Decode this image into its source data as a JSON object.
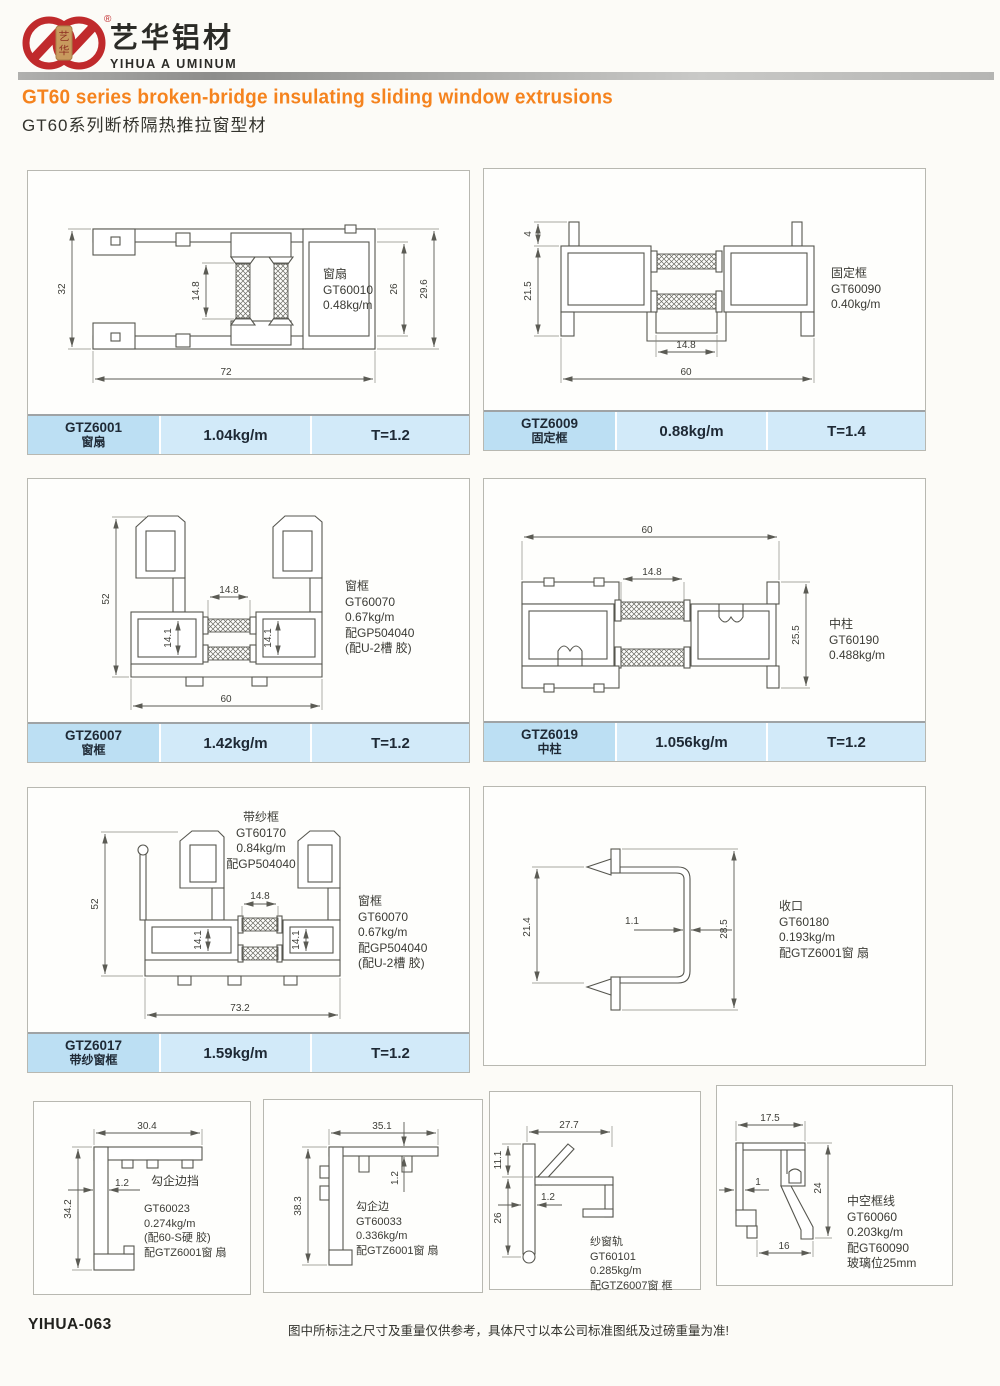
{
  "header": {
    "brand_cn": "艺华铝材",
    "brand_en": "YIHUA A UMINUM",
    "registered": "®",
    "seal_top": "艺",
    "seal_bottom": "华",
    "title_en": "GT60 series broken-bridge insulating sliding window extrusions",
    "title_cn": "GT60系列断桥隔热推拉窗型材"
  },
  "panels": {
    "p1": {
      "label": [
        "窗扇",
        "GT60010",
        "0.48kg/m"
      ],
      "dims": {
        "left": "32",
        "mid": "14.8",
        "inner_right": "26",
        "outer_right": "29.6",
        "bottom": "72"
      },
      "code": "GTZ6001",
      "name": "窗扇",
      "weight": "1.04kg/m",
      "thickness": "T=1.2"
    },
    "p2": {
      "label": [
        "固定框",
        "GT60090",
        "0.40kg/m"
      ],
      "dims": {
        "top": "4",
        "left": "21.5",
        "mid": "14.8",
        "bottom": "60"
      },
      "code": "GTZ6009",
      "name": "固定框",
      "weight": "0.88kg/m",
      "thickness": "T=1.4"
    },
    "p3": {
      "label": [
        "窗框",
        "GT60070",
        "0.67kg/m",
        "配GP504040",
        "(配U-2槽 胶)"
      ],
      "dims": {
        "left": "52",
        "mid": "14.8",
        "cav_left": "14.1",
        "cav_right": "14.1",
        "bottom": "60"
      },
      "code": "GTZ6007",
      "name": "窗框",
      "weight": "1.42kg/m",
      "thickness": "T=1.2"
    },
    "p4": {
      "label": [
        "中柱",
        "GT60190",
        "0.488kg/m"
      ],
      "dims": {
        "top": "60",
        "mid": "14.8",
        "right": "25.5"
      },
      "code": "GTZ6019",
      "name": "中柱",
      "weight": "1.056kg/m",
      "thickness": "T=1.2"
    },
    "p5": {
      "top_label": [
        "带纱框",
        "GT60170",
        "0.84kg/m",
        "配GP504040"
      ],
      "label": [
        "窗框",
        "GT60070",
        "0.67kg/m",
        "配GP504040",
        "(配U-2槽 胶)"
      ],
      "dims": {
        "left": "52",
        "mid": "14.8",
        "cav_left": "14.1",
        "cav_right": "14.1",
        "bottom": "73.2"
      },
      "code": "GTZ6017",
      "name": "带纱窗框",
      "weight": "1.59kg/m",
      "thickness": "T=1.2"
    },
    "p6": {
      "label": [
        "收口",
        "GT60180",
        "0.193kg/m",
        "配GTZ6001窗 扇"
      ],
      "dims": {
        "left": "21.4",
        "mid": "1.1",
        "right": "28.5"
      }
    }
  },
  "small_panels": {
    "s1": {
      "title": "勾企边挡",
      "label": [
        "GT60023",
        "0.274kg/m",
        "(配60-S硬 胶)",
        "配GTZ6001窗 扇"
      ],
      "dims": {
        "top": "30.4",
        "mid": "1.2",
        "left": "34.2"
      }
    },
    "s2": {
      "label": [
        "勾企边",
        "GT60033",
        "0.336kg/m",
        "配GTZ6001窗 扇"
      ],
      "dims": {
        "top": "35.1",
        "mid": "1.2",
        "left": "38.3"
      }
    },
    "s3": {
      "label": [
        "纱窗轨",
        "GT60101",
        "0.285kg/m",
        "配GTZ6007窗 框"
      ],
      "dims": {
        "top": "27.7",
        "upper_left": "11.1",
        "mid": "1.2",
        "lower_left": "26"
      }
    },
    "s4": {
      "label": [
        "中空框线",
        "GT60060",
        "0.203kg/m",
        "配GT60090",
        "玻璃位25mm"
      ],
      "dims": {
        "top": "17.5",
        "mid": "1",
        "right": "24",
        "bottom": "16"
      }
    }
  },
  "footer": {
    "page_code": "YIHUA-063",
    "disclaimer": "图中所标注之尺寸及重量仅供参考，具体尺寸以本公司标准图纸及过磅重量为准!"
  },
  "colors": {
    "accent_orange": "#f5831e",
    "logo_red": "#c02a2c",
    "table_blue": "#d2eaf9",
    "table_blue_dark": "#bcdff3"
  }
}
